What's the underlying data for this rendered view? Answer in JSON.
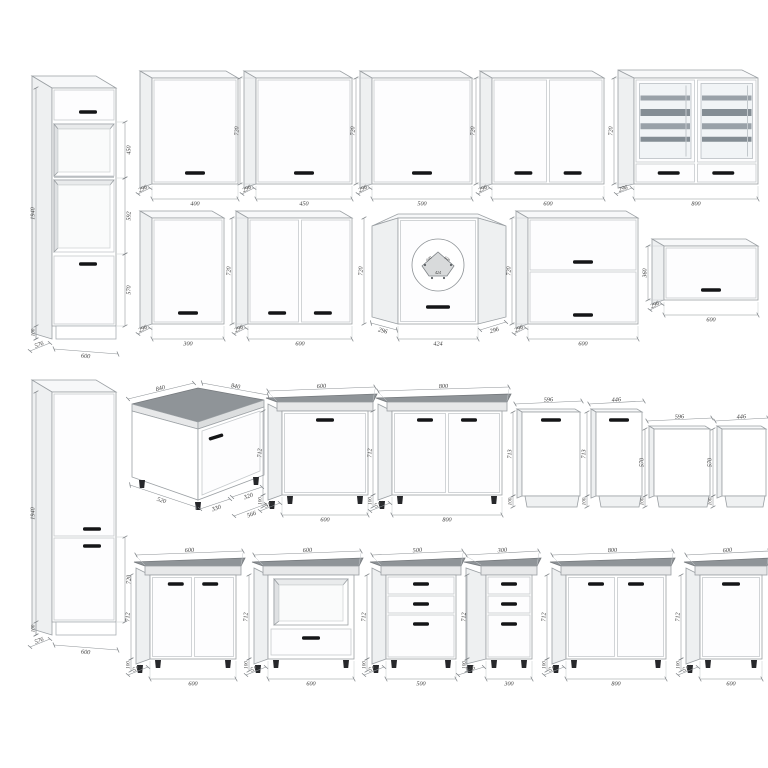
{
  "page": {
    "background": "#ffffff"
  },
  "colors": {
    "line": "#9ba0a4",
    "dim_line": "#8d9296",
    "dim_tick": "#787d81",
    "dim_text": "#3b3b3b",
    "front": "#ffffff",
    "door": "#fdfdfe",
    "side": "#eef0f1",
    "top": "#f7f8f9",
    "worktop": "#8f9498",
    "worktop_edge": "#e7e8e9",
    "handle": "#141517",
    "glass": "#f1f4f6",
    "glass_shelf": "#99a1a8",
    "glass_shelf_dark": "#848d94",
    "leg": "#26272a",
    "interior": "#e9ebec",
    "interior_dark": "#dfe1e3",
    "plan_fill": "#d8dadb"
  },
  "cabinets": [
    {
      "id": "tall-oven-housing-600",
      "dims": {
        "total_height": "1940",
        "upper_section": "450",
        "middle_section": "592",
        "lower_door": "570",
        "plinth": "100",
        "depth": "576",
        "width": "600"
      }
    },
    {
      "id": "wall-cabinet-400",
      "dims": {
        "width": "400",
        "height": "720",
        "depth": "296"
      }
    },
    {
      "id": "wall-cabinet-450",
      "dims": {
        "width": "450",
        "height": "720",
        "depth": "296"
      }
    },
    {
      "id": "wall-cabinet-500",
      "dims": {
        "width": "500",
        "height": "720",
        "depth": "296"
      }
    },
    {
      "id": "wall-cabinet-600-2door",
      "dims": {
        "width": "600",
        "height": "720",
        "depth": "296"
      }
    },
    {
      "id": "wall-cabinet-800-glass",
      "dims": {
        "width": "800",
        "height": "720",
        "depth": "296"
      }
    },
    {
      "id": "wall-cabinet-300",
      "dims": {
        "width": "300",
        "height": "720",
        "depth": "296"
      }
    },
    {
      "id": "wall-cabinet-600-2door-b",
      "dims": {
        "width": "600",
        "height": "720",
        "depth": "296"
      }
    },
    {
      "id": "wall-corner-cabinet-424",
      "dims": {
        "height": "720",
        "left_side": "296",
        "front": "424",
        "right_side": "296"
      },
      "plan": {
        "left": "600",
        "right": "600",
        "front": "424"
      }
    },
    {
      "id": "wall-cabinet-600-flap2",
      "dims": {
        "width": "600",
        "height": "720",
        "depth": "296"
      }
    },
    {
      "id": "wall-cabinet-600-flap1",
      "dims": {
        "width": "600",
        "height": "360",
        "depth": "296"
      }
    },
    {
      "id": "tall-fridge-housing-600",
      "dims": {
        "total_height": "1940",
        "lower_door": "720",
        "plinth": "100",
        "depth": "576",
        "width": "600"
      }
    },
    {
      "id": "base-corner-cabinet-840",
      "dims": {
        "left_top": "840",
        "right_top": "840",
        "left_depth": "520",
        "front_left": "330",
        "front_right": "320",
        "right_depth": "566"
      }
    },
    {
      "id": "base-cabinet-600-1door",
      "dims": {
        "width": "600",
        "height": "712",
        "depth": "516",
        "legs": "100"
      }
    },
    {
      "id": "base-cabinet-800-2door",
      "dims": {
        "width": "800",
        "height": "712",
        "depth": "516",
        "legs": "100"
      }
    },
    {
      "id": "dishwasher-front-596",
      "dims": {
        "width": "596",
        "height": "713",
        "bottom": "100"
      }
    },
    {
      "id": "dishwasher-front-446",
      "dims": {
        "width": "446",
        "height": "713",
        "bottom": "100"
      }
    },
    {
      "id": "appliance-panel-596",
      "dims": {
        "width": "596",
        "height": "570",
        "bottom": "100"
      }
    },
    {
      "id": "appliance-panel-446",
      "dims": {
        "width": "446",
        "height": "570",
        "bottom": "100"
      }
    },
    {
      "id": "base-cabinet-600-2door",
      "dims": {
        "width": "600",
        "height": "712",
        "depth": "516",
        "legs": "100"
      }
    },
    {
      "id": "base-oven-housing-600",
      "dims": {
        "width": "600",
        "height": "712",
        "depth": "516",
        "legs": "100"
      }
    },
    {
      "id": "base-drawer-cabinet-500",
      "dims": {
        "width": "500",
        "height": "712",
        "depth": "516",
        "legs": "100"
      }
    },
    {
      "id": "base-drawer-cabinet-300",
      "dims": {
        "width": "300",
        "height": "712",
        "depth": "546",
        "legs": "100"
      }
    },
    {
      "id": "base-cabinet-800-2door-b",
      "dims": {
        "width": "800",
        "height": "712",
        "depth": "516",
        "legs": "100"
      }
    },
    {
      "id": "base-cabinet-600-1door-b",
      "dims": {
        "width": "600",
        "height": "712",
        "depth": "516",
        "legs": "100"
      }
    }
  ]
}
